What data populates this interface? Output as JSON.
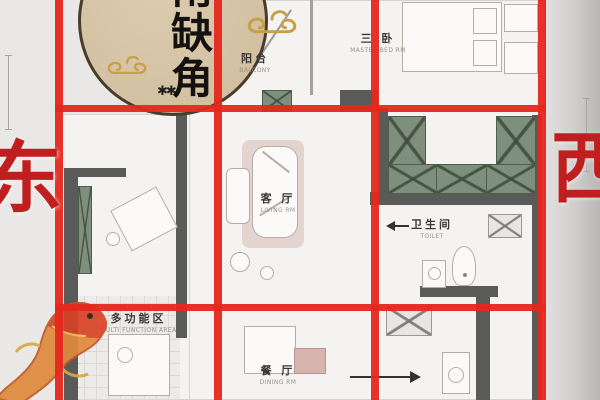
{
  "corner_note": {
    "text": "南缺角",
    "char_1": "南",
    "char_2": "缺",
    "char_3": "角"
  },
  "compass": {
    "east": "东",
    "west": "西"
  },
  "rooms": {
    "balcony": {
      "name_zh": "阳台",
      "name_en": "BALCONY"
    },
    "third_bedroom": {
      "name_zh": "三 卧",
      "name_en": "MASTER BED RM"
    },
    "living_room": {
      "name_zh": "客 厅",
      "name_en": "LIVING RM"
    },
    "toilet": {
      "name_zh": "卫生间",
      "name_en": "TOILET"
    },
    "multi_function": {
      "name_zh": "多功能区",
      "name_en": "MULTI FUNCTION AREA"
    },
    "dining_room": {
      "name_zh": "餐 厅",
      "name_en": "DINING RM"
    }
  },
  "icons": {
    "plant_glyph": "✱✱"
  },
  "grid": {
    "v_lines_x": [
      55,
      214,
      371,
      538
    ],
    "h_lines_y": [
      105,
      304
    ],
    "thickness_px": 7
  },
  "colors": {
    "grid_red": "#e5271c",
    "compass_red": "#c01f1f",
    "wall_gray": "#5a5a58",
    "cabinet_green": "#7f8f7d",
    "moon_tan": "#d5c3a5",
    "cloud_gold": "#c79f45",
    "koi_orange": "#e08a3c",
    "koi_red": "#d84328"
  }
}
